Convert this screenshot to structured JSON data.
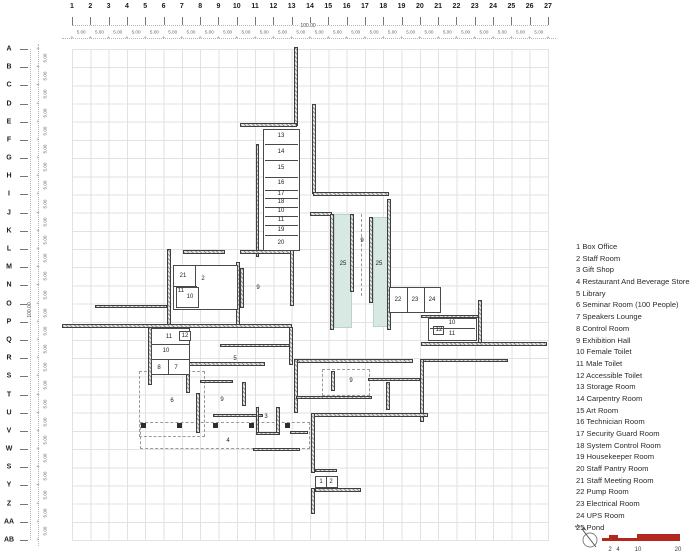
{
  "grid_axes": {
    "columns": [
      "1",
      "2",
      "3",
      "4",
      "5",
      "6",
      "7",
      "8",
      "9",
      "10",
      "11",
      "12",
      "13",
      "14",
      "15",
      "16",
      "17",
      "18",
      "19",
      "20",
      "21",
      "22",
      "23",
      "24",
      "25",
      "26",
      "27"
    ],
    "rows": [
      "A",
      "B",
      "C",
      "D",
      "E",
      "F",
      "G",
      "H",
      "I",
      "J",
      "K",
      "L",
      "M",
      "N",
      "O",
      "P",
      "Q",
      "R",
      "S",
      "T",
      "U",
      "V",
      "W",
      "S",
      "Y",
      "Z",
      "AA",
      "AB"
    ],
    "col_spacing_label": "5.00",
    "row_spacing_label": "5.00",
    "total_width_label": "100.00",
    "total_height_label": "100.00",
    "marker_glyph": "+"
  },
  "legend": {
    "items": [
      {
        "num": "1",
        "name": "Box Office"
      },
      {
        "num": "2",
        "name": "Staff Room"
      },
      {
        "num": "3",
        "name": "Gift Shop"
      },
      {
        "num": "4",
        "name": "Restaurant And Beverage Store"
      },
      {
        "num": "5",
        "name": "Library"
      },
      {
        "num": "6",
        "name": "Seminar Room (100 People)"
      },
      {
        "num": "7",
        "name": "Speakers Lounge"
      },
      {
        "num": "8",
        "name": "Control Room"
      },
      {
        "num": "9",
        "name": "Exhibition Hall"
      },
      {
        "num": "10",
        "name": "Female Toilet"
      },
      {
        "num": "11",
        "name": "Male Toilet"
      },
      {
        "num": "12",
        "name": "Accessible Toilet"
      },
      {
        "num": "13",
        "name": "Storage Room"
      },
      {
        "num": "14",
        "name": "Carpentry Room"
      },
      {
        "num": "15",
        "name": "Art Room"
      },
      {
        "num": "16",
        "name": "Technician Room"
      },
      {
        "num": "17",
        "name": "Security Guard Room"
      },
      {
        "num": "18",
        "name": "System Control Room"
      },
      {
        "num": "19",
        "name": "Housekeeper Room"
      },
      {
        "num": "20",
        "name": "Staff Pantry Room"
      },
      {
        "num": "21",
        "name": "Staff Meeting Room"
      },
      {
        "num": "22",
        "name": "Pump Room"
      },
      {
        "num": "23",
        "name": "Electrical Room"
      },
      {
        "num": "24",
        "name": "UPS Room"
      },
      {
        "num": "25",
        "name": "Pond"
      }
    ]
  },
  "plan": {
    "wall_color": "#3f3f3f",
    "pond_color": "#d8e8e3",
    "walls": [
      [
        294,
        47,
        4,
        79
      ],
      [
        240,
        123,
        57,
        4
      ],
      [
        256,
        144,
        3,
        113
      ],
      [
        312,
        104,
        4,
        90
      ],
      [
        313,
        192,
        76,
        4
      ],
      [
        387,
        199,
        4,
        131
      ],
      [
        310,
        212,
        22,
        4
      ],
      [
        330,
        214,
        4,
        116
      ],
      [
        350,
        214,
        4,
        78
      ],
      [
        369,
        217,
        4,
        86
      ],
      [
        167,
        249,
        4,
        79
      ],
      [
        183,
        250,
        42,
        4
      ],
      [
        240,
        250,
        52,
        4
      ],
      [
        290,
        250,
        4,
        56
      ],
      [
        240,
        268,
        4,
        40
      ],
      [
        236,
        262,
        4,
        64
      ],
      [
        95,
        305,
        72,
        3
      ],
      [
        62,
        324,
        230,
        4
      ],
      [
        289,
        327,
        4,
        38
      ],
      [
        478,
        300,
        4,
        44
      ],
      [
        421,
        315,
        58,
        3
      ],
      [
        421,
        342,
        126,
        4
      ],
      [
        420,
        359,
        88,
        3
      ],
      [
        420,
        359,
        4,
        63
      ],
      [
        368,
        378,
        52,
        3
      ],
      [
        386,
        382,
        4,
        28
      ],
      [
        294,
        359,
        119,
        4
      ],
      [
        294,
        359,
        4,
        54
      ],
      [
        331,
        371,
        4,
        20
      ],
      [
        296,
        396,
        76,
        3
      ],
      [
        313,
        413,
        115,
        4
      ],
      [
        311,
        413,
        4,
        60
      ],
      [
        315,
        469,
        22,
        3
      ],
      [
        315,
        488,
        46,
        4
      ],
      [
        311,
        488,
        4,
        26
      ],
      [
        290,
        431,
        18,
        3
      ],
      [
        183,
        362,
        82,
        4
      ],
      [
        186,
        366,
        4,
        27
      ],
      [
        200,
        380,
        33,
        3
      ],
      [
        196,
        393,
        4,
        40
      ],
      [
        213,
        414,
        50,
        3
      ],
      [
        242,
        382,
        4,
        24
      ],
      [
        256,
        407,
        3,
        27
      ],
      [
        276,
        407,
        4,
        27
      ],
      [
        256,
        432,
        24,
        3
      ],
      [
        253,
        448,
        47,
        3
      ],
      [
        220,
        344,
        70,
        3
      ],
      [
        148,
        327,
        4,
        58
      ]
    ],
    "room_boxes": [
      [
        263,
        129,
        37,
        122
      ],
      [
        173,
        265,
        65,
        45
      ],
      [
        176,
        287,
        23,
        21
      ],
      [
        389,
        287,
        52,
        26
      ],
      [
        428,
        318,
        49,
        23
      ],
      [
        433,
        326,
        11,
        9
      ],
      [
        151,
        328,
        39,
        47
      ],
      [
        179,
        331,
        12,
        10
      ],
      [
        315,
        476,
        23,
        12
      ]
    ],
    "partitions": [
      [
        265,
        144,
        33,
        1
      ],
      [
        265,
        160,
        33,
        1
      ],
      [
        265,
        177,
        33,
        1
      ],
      [
        265,
        190,
        33,
        1
      ],
      [
        265,
        198,
        33,
        1
      ],
      [
        265,
        207,
        33,
        1
      ],
      [
        265,
        216,
        33,
        1
      ],
      [
        265,
        225,
        33,
        1
      ],
      [
        265,
        235,
        33,
        1
      ],
      [
        195,
        266,
        1,
        21
      ],
      [
        174,
        286,
        23,
        1
      ],
      [
        407,
        288,
        1,
        24
      ],
      [
        424,
        288,
        1,
        24
      ],
      [
        430,
        328,
        45,
        1
      ],
      [
        152,
        344,
        37,
        1
      ],
      [
        152,
        359,
        37,
        1
      ],
      [
        168,
        360,
        1,
        14
      ],
      [
        326,
        477,
        1,
        10
      ]
    ],
    "ponds": [
      [
        334,
        214,
        16,
        112
      ],
      [
        373,
        217,
        16,
        108
      ]
    ],
    "room_labels": [
      {
        "t": "13",
        "x": 281,
        "y": 136
      },
      {
        "t": "14",
        "x": 281,
        "y": 152
      },
      {
        "t": "15",
        "x": 281,
        "y": 168
      },
      {
        "t": "16",
        "x": 281,
        "y": 183
      },
      {
        "t": "17",
        "x": 281,
        "y": 194
      },
      {
        "t": "18",
        "x": 281,
        "y": 202
      },
      {
        "t": "10",
        "x": 281,
        "y": 211
      },
      {
        "t": "11",
        "x": 281,
        "y": 220
      },
      {
        "t": "19",
        "x": 281,
        "y": 230
      },
      {
        "t": "20",
        "x": 281,
        "y": 243
      },
      {
        "t": "21",
        "x": 183,
        "y": 276
      },
      {
        "t": "2",
        "x": 203,
        "y": 279
      },
      {
        "t": "11",
        "x": 181,
        "y": 291
      },
      {
        "t": "10",
        "x": 190,
        "y": 297
      },
      {
        "t": "9",
        "x": 258,
        "y": 288
      },
      {
        "t": "9",
        "x": 362,
        "y": 241
      },
      {
        "t": "25",
        "x": 343,
        "y": 264
      },
      {
        "t": "25",
        "x": 379,
        "y": 264
      },
      {
        "t": "22",
        "x": 398,
        "y": 300
      },
      {
        "t": "23",
        "x": 415,
        "y": 300
      },
      {
        "t": "24",
        "x": 432,
        "y": 300
      },
      {
        "t": "10",
        "x": 452,
        "y": 323
      },
      {
        "t": "12",
        "x": 439,
        "y": 330
      },
      {
        "t": "11",
        "x": 452,
        "y": 334
      },
      {
        "t": "11",
        "x": 169,
        "y": 337
      },
      {
        "t": "12",
        "x": 185,
        "y": 336
      },
      {
        "t": "10",
        "x": 166,
        "y": 351
      },
      {
        "t": "8",
        "x": 159,
        "y": 368
      },
      {
        "t": "7",
        "x": 176,
        "y": 368
      },
      {
        "t": "5",
        "x": 235,
        "y": 359
      },
      {
        "t": "6",
        "x": 172,
        "y": 401
      },
      {
        "t": "9",
        "x": 222,
        "y": 400
      },
      {
        "t": "3",
        "x": 266,
        "y": 417
      },
      {
        "t": "4",
        "x": 228,
        "y": 441
      },
      {
        "t": "9",
        "x": 351,
        "y": 381
      },
      {
        "t": "1",
        "x": 321,
        "y": 482
      },
      {
        "t": "2",
        "x": 331,
        "y": 482
      }
    ],
    "dashed_boxes": [
      [
        139,
        371,
        66,
        66
      ],
      [
        140,
        422,
        170,
        27
      ],
      [
        322,
        369,
        48,
        27
      ]
    ],
    "dashed_vlines": [
      [
        361,
        214,
        82
      ]
    ],
    "column_squares": [
      [
        141,
        423
      ],
      [
        177,
        423
      ],
      [
        213,
        423
      ],
      [
        249,
        423
      ],
      [
        285,
        423
      ]
    ]
  },
  "scale_bar": {
    "labels": [
      "2",
      "4",
      "10",
      "20"
    ],
    "color": "#b3281e"
  },
  "north_indicator": {
    "label": "N"
  }
}
